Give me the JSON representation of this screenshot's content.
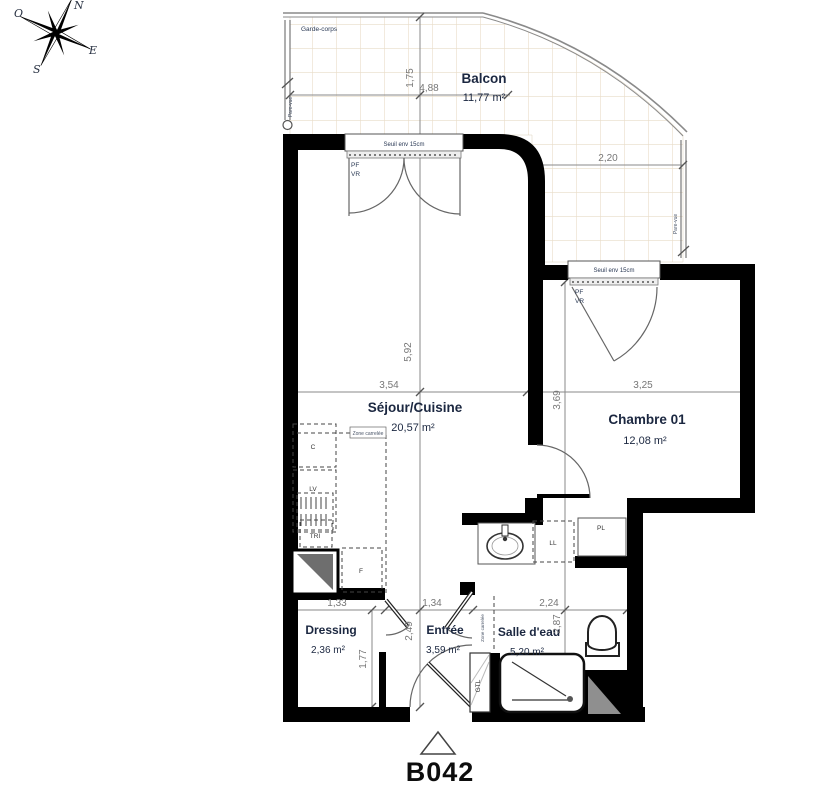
{
  "unit": {
    "label": "B042"
  },
  "compass": {
    "n": "N",
    "e": "E",
    "s": "S",
    "o": "O"
  },
  "rooms": {
    "balcon": {
      "name": "Balcon",
      "area": "11,77 m²"
    },
    "sejour": {
      "name": "Séjour/Cuisine",
      "area": "20,57 m²"
    },
    "chambre": {
      "name": "Chambre 01",
      "area": "12,08 m²"
    },
    "dressing": {
      "name": "Dressing",
      "area": "2,36 m²"
    },
    "entree": {
      "name": "Entrée",
      "area": "3,59 m²"
    },
    "salle_eau": {
      "name": "Salle d'eau",
      "area": "5,20 m²"
    }
  },
  "dimensions": {
    "balcon_width": "4,88",
    "balcon_depth": "1,75",
    "balcon_right_width": "2,20",
    "sejour_width": "3,54",
    "sejour_height": "5,92",
    "chambre_width": "3,25",
    "chambre_height": "3,69",
    "dressing_width": "1,33",
    "dressing_height": "1,77",
    "entree_width": "1,34",
    "entree_height": "2,49",
    "salle_eau_width": "2,24",
    "salle_eau_height": "2,87"
  },
  "annotations": {
    "garde_corps": "Garde-corps",
    "pare_vue": "Pare-vue",
    "seuil": "Seuil env 15cm",
    "pf": "PF",
    "vr": "VR",
    "zone_carrelee": "Zone carrelée"
  },
  "fixtures": {
    "c": "C",
    "lv": "LV",
    "tri": "TRI",
    "f": "F",
    "ll": "LL",
    "pl": "PL",
    "gtl": "GTL"
  }
}
